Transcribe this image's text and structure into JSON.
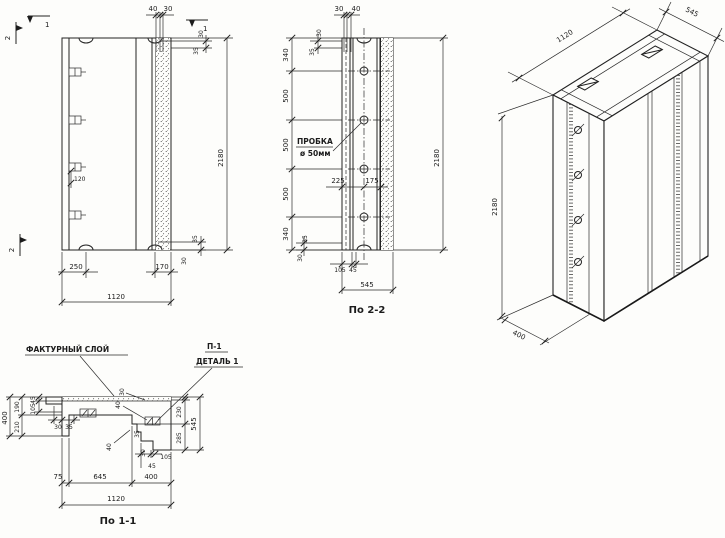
{
  "elevation": {
    "section_marks": {
      "top_1": "1",
      "right_1": "1",
      "left_2": "2",
      "bottom_2": "2"
    },
    "top_dims": [
      "40",
      "30"
    ],
    "right_top_dims": [
      "30",
      "35"
    ],
    "height_dim": "2180",
    "stud_dim": "120",
    "right_bottom_dims": [
      "35",
      "30"
    ],
    "bottom_dims": [
      "250",
      "170"
    ],
    "width_dim": "1120"
  },
  "section_2_2": {
    "caption": "По 2-2",
    "top_dims": [
      "30",
      "40"
    ],
    "top_left_dims": [
      "30",
      "35"
    ],
    "left_dims": [
      "340",
      "500",
      "500",
      "500",
      "340"
    ],
    "plug_label_line1": "ПРОБКА",
    "plug_label_line2": "ø 50мм",
    "mid_dims": [
      "225",
      "175"
    ],
    "height_dim": "2180",
    "bottom_left_dims": [
      "35",
      "30"
    ],
    "bottom_small_dims": [
      "105",
      "45"
    ],
    "width_dim": "545"
  },
  "isometric": {
    "width_dim": "1120",
    "depth_dim": "545",
    "height_dim": "2180",
    "base_dim": "400"
  },
  "section_1_1": {
    "caption": "По 1-1",
    "facture_label": "ФАКТУРНЫЙ СЛОЙ",
    "p1_label": "П-1",
    "detail_label": "ДЕТАЛЬ 1",
    "left_total_dim": "400",
    "left_dims": [
      "190",
      "210"
    ],
    "left_small_dims": [
      "45",
      "105"
    ],
    "left_step_dims": [
      "30",
      "35"
    ],
    "slab_dims": [
      "30",
      "40"
    ],
    "right_dims": [
      "230",
      "285"
    ],
    "right_total_dim": "545",
    "step_dims": [
      "40",
      "35",
      "30",
      "105",
      "45"
    ],
    "bottom_dims": [
      "75",
      "645",
      "400"
    ],
    "width_dim": "1120"
  }
}
